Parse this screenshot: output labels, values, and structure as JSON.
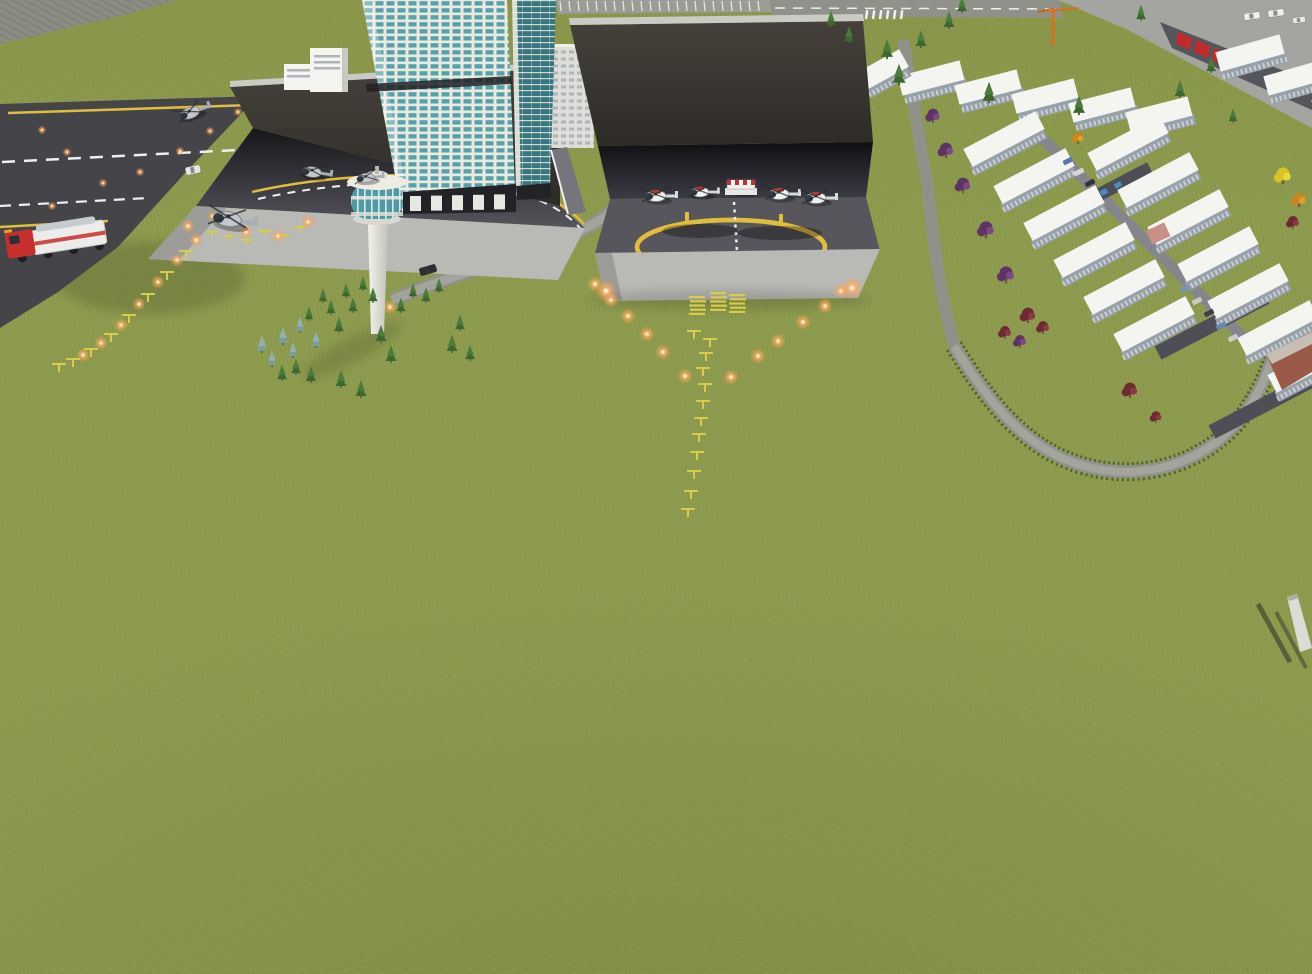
{
  "scene": {
    "type": "3d-city-heliport-simulation-viewport",
    "colors": {
      "grass": "#8E9C50",
      "slope": "#8C8C84",
      "slope_line": "#7B7B73",
      "runway": "#454549",
      "line_yellow": "#E0BE3C",
      "line_white": "#EFEFEF",
      "canopy_hi": "#45413A",
      "canopy_lo": "#2E2B27",
      "canopy_edge": "#CBCBC5",
      "recess_hi": "#16161A",
      "recess_lo": "#55555C",
      "recessc_hi": "#0F0F13",
      "recessc_lo": "#3C3C44",
      "pad": "#56565C",
      "ramp": "#B9B9B5",
      "ramp_shade": "#9C9C98",
      "road": "#90928A",
      "road_light": "#A3A59D",
      "hedge": "#4E6233",
      "access": "#75757B",
      "white_bldg": "#F4F4F0",
      "facade": "#98A0AA",
      "roof_dark": "#4E4E56",
      "bldg_side": "#C9C9C3",
      "win_gray": "#AEB4BA",
      "apron": "#A4A4A0",
      "warehouse": "#55555C",
      "red_panel": "#C22B2B",
      "crane": "#D4721E",
      "frame": "#ECEAE0",
      "glass": "#55A2AA",
      "glass_dark": "#3A7680",
      "band": "#232327",
      "cab_glass": "#4E9AA6",
      "cab_white": "#ECECE4",
      "shaft_hi": "#F4F4EE",
      "shaft_lo": "#C2C2B8",
      "brick": "#9A5A48",
      "brick_roof": "#C6BEB4",
      "hut": "#C99086",
      "light_yellow": "#DACB4C",
      "glow_in": "#FFE9C6",
      "glow_mid": "#FFB066",
      "glow_out": "#FF9840",
      "truck_red": "#C62F2C",
      "truck_white": "#ECECEA",
      "metal": "#C6CBCF",
      "skylight_blue": "#4A8CC8",
      "wall_light": "#DCDCD6",
      "wall_shadow": "#2E2E26"
    },
    "tree_palette": {
      "conifer": [
        "#3C682F",
        "#4C7C3B"
      ],
      "spruce": [
        "#7E9C98",
        "#93B0AC"
      ],
      "purple": [
        "#5E3366",
        "#7A4886"
      ],
      "darkred": [
        "#6E2A32",
        "#8A3A42"
      ],
      "yellow": [
        "#D8C428",
        "#E8DA3A"
      ],
      "orange": [
        "#C9861F",
        "#E09F33"
      ]
    },
    "heli_palette": {
      "gray_body": "#C2C8CC",
      "gray_tail": "#A8AEB4",
      "wr_body": "#EEF1F3",
      "wr_tail": "#D8DCDE",
      "red": "#C23030",
      "glass": "#323A44",
      "rotor": "rgba(40,40,44,0.75)"
    },
    "trees": [
      [
        262,
        352,
        "spruce",
        1
      ],
      [
        272,
        366,
        "spruce",
        0.9
      ],
      [
        283,
        344,
        "spruce",
        1
      ],
      [
        293,
        357,
        "spruce",
        0.85
      ],
      [
        300,
        332,
        "spruce",
        0.9
      ],
      [
        309,
        320,
        "conifer",
        0.8
      ],
      [
        316,
        347,
        "spruce",
        0.9
      ],
      [
        323,
        302,
        "conifer",
        0.8
      ],
      [
        331,
        314,
        "conifer",
        0.85
      ],
      [
        339,
        332,
        "conifer",
        0.9
      ],
      [
        346,
        297,
        "conifer",
        0.8
      ],
      [
        353,
        312,
        "conifer",
        0.85
      ],
      [
        363,
        290,
        "conifer",
        0.8
      ],
      [
        373,
        302,
        "conifer",
        0.85
      ],
      [
        381,
        342,
        "conifer",
        1
      ],
      [
        391,
        362,
        "conifer",
        1
      ],
      [
        401,
        312,
        "conifer",
        0.85
      ],
      [
        413,
        297,
        "conifer",
        0.8
      ],
      [
        426,
        302,
        "conifer",
        0.85
      ],
      [
        439,
        292,
        "conifer",
        0.8
      ],
      [
        452,
        352,
        "conifer",
        1
      ],
      [
        341,
        387,
        "conifer",
        1
      ],
      [
        361,
        397,
        "conifer",
        1
      ],
      [
        311,
        382,
        "conifer",
        0.95
      ],
      [
        296,
        374,
        "conifer",
        0.9
      ],
      [
        282,
        380,
        "conifer",
        0.9
      ],
      [
        460,
        330,
        "conifer",
        0.9
      ],
      [
        470,
        360,
        "conifer",
        0.9
      ],
      [
        887,
        58,
        "conifer",
        1.1
      ],
      [
        899,
        84,
        "conifer",
        1.2
      ],
      [
        949,
        28,
        "conifer",
        1
      ],
      [
        989,
        102,
        "conifer",
        1.2
      ],
      [
        1079,
        114,
        "conifer",
        1.1
      ],
      [
        1180,
        97,
        "conifer",
        1
      ],
      [
        1211,
        72,
        "conifer",
        0.9
      ],
      [
        1141,
        20,
        "conifer",
        0.9
      ],
      [
        962,
        12,
        "conifer",
        0.9
      ],
      [
        921,
        47,
        "conifer",
        1
      ],
      [
        831,
        26,
        "conifer",
        0.9
      ],
      [
        849,
        42,
        "conifer",
        0.9
      ],
      [
        1233,
        122,
        "conifer",
        0.8
      ],
      [
        933,
        122,
        "purple",
        1.1
      ],
      [
        946,
        157,
        "purple",
        1.2
      ],
      [
        963,
        192,
        "purple",
        1.2
      ],
      [
        986,
        237,
        "purple",
        1.3
      ],
      [
        1006,
        282,
        "purple",
        1.3
      ],
      [
        1028,
        322,
        "darkred",
        1.2
      ],
      [
        1020,
        347,
        "purple",
        1
      ],
      [
        1130,
        397,
        "darkred",
        1.2
      ],
      [
        1043,
        333,
        "darkred",
        1
      ],
      [
        1156,
        422,
        "darkred",
        0.9
      ],
      [
        1005,
        338,
        "darkred",
        1
      ],
      [
        1283,
        183,
        "yellow",
        1.3
      ],
      [
        1299,
        206,
        "orange",
        1.1
      ],
      [
        1293,
        228,
        "darkred",
        1
      ],
      [
        1078,
        143,
        "orange",
        0.9
      ]
    ],
    "runway_lights": [
      [
        42,
        130
      ],
      [
        67,
        152
      ],
      [
        103,
        183
      ],
      [
        140,
        172
      ],
      [
        180,
        151
      ],
      [
        210,
        131
      ],
      [
        238,
        112
      ],
      [
        52,
        206
      ],
      [
        92,
        232
      ],
      [
        212,
        216
      ]
    ],
    "approach_center": {
      "clusters": [
        [
          697,
          296
        ],
        [
          718,
          292
        ],
        [
          737,
          294
        ]
      ],
      "stands": [
        [
          694,
          331
        ],
        [
          710,
          339
        ],
        [
          706,
          353
        ],
        [
          703,
          368
        ],
        [
          705,
          384
        ],
        [
          703,
          401
        ],
        [
          701,
          418
        ],
        [
          699,
          434
        ],
        [
          697,
          452
        ],
        [
          694,
          471
        ],
        [
          691,
          491
        ],
        [
          688,
          509
        ]
      ],
      "v_left": [
        [
          595,
          284
        ],
        [
          611,
          300
        ],
        [
          628,
          316
        ],
        [
          647,
          334
        ],
        [
          663,
          352
        ],
        [
          685,
          376
        ]
      ],
      "v_right": [
        [
          841,
          291
        ],
        [
          825,
          306
        ],
        [
          803,
          322
        ],
        [
          778,
          341
        ],
        [
          758,
          356
        ],
        [
          731,
          377
        ]
      ],
      "ramp_glows": [
        [
          606,
          291
        ],
        [
          852,
          288
        ]
      ]
    },
    "approach_left": {
      "bars": [
        [
          212,
          232
        ],
        [
          229,
          236
        ],
        [
          247,
          240
        ],
        [
          265,
          231
        ],
        [
          283,
          235
        ],
        [
          300,
          227
        ]
      ],
      "stands": [
        [
          186,
          251
        ],
        [
          167,
          272
        ],
        [
          148,
          294
        ],
        [
          129,
          315
        ],
        [
          111,
          334
        ],
        [
          91,
          349
        ],
        [
          73,
          359
        ],
        [
          59,
          364
        ]
      ],
      "glows": [
        [
          188,
          226
        ],
        [
          246,
          232
        ],
        [
          278,
          236
        ],
        [
          308,
          222
        ],
        [
          196,
          240
        ],
        [
          177,
          260
        ],
        [
          158,
          282
        ],
        [
          139,
          304
        ],
        [
          121,
          325
        ],
        [
          101,
          343
        ],
        [
          83,
          355
        ],
        [
          390,
          307
        ]
      ]
    },
    "helicopters": [
      {
        "x": 190,
        "y": 113,
        "s": 1.0,
        "r": -20,
        "st": "gray"
      },
      {
        "x": 312,
        "y": 172,
        "s": 0.95,
        "r": 8,
        "st": "gray"
      },
      {
        "x": 366,
        "y": 178,
        "s": 0.85,
        "r": -6,
        "st": "gray"
      },
      {
        "x": 228,
        "y": 219,
        "s": 1.35,
        "r": 10,
        "st": "gray"
      },
      {
        "x": 656,
        "y": 196,
        "s": 1.0,
        "r": 0,
        "st": "wr"
      },
      {
        "x": 700,
        "y": 192,
        "s": 0.9,
        "r": 0,
        "st": "wr"
      },
      {
        "x": 779,
        "y": 194,
        "s": 1.0,
        "r": 0,
        "st": "wr"
      },
      {
        "x": 816,
        "y": 198,
        "s": 1.0,
        "r": 0,
        "st": "wr"
      },
      {
        "x": 741,
        "y": 188,
        "s": 1.0,
        "r": 0,
        "st": "striped"
      }
    ],
    "cars": [
      {
        "x": 193,
        "y": 170,
        "r": -12,
        "c": "#E8E8E2",
        "w": 15,
        "h": 8
      },
      {
        "x": 428,
        "y": 270,
        "r": -16,
        "c": "#2E2E32",
        "w": 17,
        "h": 8
      },
      {
        "x": 1252,
        "y": 16,
        "r": -8,
        "c": "#EEEEEA",
        "w": 16,
        "h": 7
      },
      {
        "x": 1276,
        "y": 13,
        "r": -8,
        "c": "#EEEEEA",
        "w": 16,
        "h": 7
      },
      {
        "x": 1299,
        "y": 20,
        "r": -8,
        "c": "#E8E8E4",
        "w": 13,
        "h": 6
      }
    ],
    "street_cars": [
      [
        1068,
        161
      ],
      [
        1079,
        172
      ],
      [
        1090,
        183
      ],
      [
        1185,
        289
      ],
      [
        1197,
        301
      ],
      [
        1209,
        313
      ],
      [
        1221,
        326
      ],
      [
        1233,
        338
      ]
    ],
    "street_car_colors": [
      "#5A78A8",
      "#D8D8D6",
      "#34343E",
      "#7A92B8",
      "#C8C8C6",
      "#404048",
      "#6888B0",
      "#CCCCCA"
    ],
    "residential": {
      "chains": [
        {
          "start": [
            900,
            86
          ],
          "dir": [
            62,
            -16
          ],
          "step": [
            57,
            9
          ],
          "count": 5
        },
        {
          "start": [
            968,
            158
          ],
          "dir": [
            72,
            -38
          ],
          "step": [
            30,
            37
          ],
          "count": 6
        },
        {
          "start": [
            1092,
            162
          ],
          "dir": [
            72,
            -38
          ],
          "step": [
            30,
            37
          ],
          "count": 7
        },
        {
          "start": [
            1218,
            62
          ],
          "dir": [
            64,
            -18
          ],
          "step": [
            48,
            24
          ],
          "count": 3
        },
        {
          "start": [
            864,
            80
          ],
          "dir": [
            40,
            -22
          ],
          "step": [
            0,
            0
          ],
          "count": 1
        }
      ],
      "roofs": [
        {
          "a": [
            1062,
            214
          ],
          "b": [
            1150,
            168
          ],
          "w": 13
        },
        {
          "a": [
            1158,
            353
          ],
          "b": [
            1266,
            297
          ],
          "w": 15
        },
        {
          "a": [
            1212,
            432
          ],
          "b": [
            1312,
            380
          ],
          "w": 15
        }
      ],
      "skylights": [
        [
          1076,
          206
        ],
        [
          1090,
          199
        ],
        [
          1104,
          192
        ],
        [
          1118,
          185
        ]
      ]
    },
    "parking": {
      "x1": 560,
      "x2": 766,
      "y": 1,
      "h": 10,
      "gap": 9
    },
    "crosswalk": {
      "x": 866,
      "y": 10,
      "count": 6,
      "gap": 7
    },
    "base_pillars": {
      "x": 410,
      "y": 196,
      "count": 5,
      "gap": 21,
      "w": 11,
      "h": 15
    }
  }
}
